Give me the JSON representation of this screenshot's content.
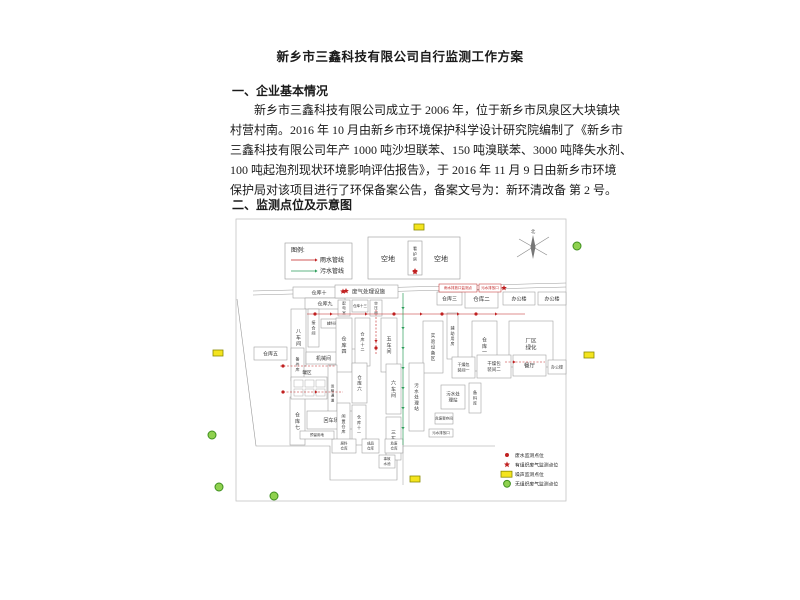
{
  "doc": {
    "title": "新乡市三鑫科技有限公司自行监测工作方案",
    "section1": "一、企业基本情况",
    "para_lines": [
      "新乡市三鑫科技有限公司成立于 2006 年，位于新乡市凤泉区大块镇块",
      "村营村南。2016 年 10 月由新乡市环境保护科学设计研究院编制了《新乡市",
      "三鑫科技有限公司年产 1000 吨沙坦联苯、150 吨溴联苯、3000 吨降失水剂、",
      "100 吨起泡剂现状环境影响评估报告》，于 2016 年 11 月 9 日由新乡市环境",
      "保护局对该项目进行了环保备案公告，备案文号为：新环清改备 第 2 号。"
    ],
    "section2": "二、监测点位及示意图"
  },
  "colors": {
    "red": "#c02020",
    "green": "#2e9e5b",
    "line": "#9a9a9a",
    "frame": "#c4c4c4",
    "text": "#444444",
    "yellow_fill": "#f4e41e",
    "yellow_stroke": "#8a8a00",
    "green_fill": "#8fd14f",
    "green_stroke": "#3f8f1f"
  },
  "diagram": {
    "frame": {
      "x": 41,
      "y": 4,
      "w": 330,
      "h": 282
    },
    "legend_top": {
      "x": 90,
      "y": 28,
      "w": 67,
      "h": 36,
      "title": "图例:",
      "items": [
        {
          "label": "雨水管线",
          "color": "#c02020"
        },
        {
          "label": "污水管线",
          "color": "#2e9e5b"
        }
      ]
    },
    "open_area": {
      "x": 173,
      "y": 22,
      "w": 92,
      "h": 42,
      "left_label": "空地",
      "right_label": "空地",
      "guard": {
        "x": 213,
        "y": 26,
        "w": 14,
        "h": 34,
        "label": "看护房"
      }
    },
    "compass": {
      "cx": 338,
      "cy": 32,
      "label": "北"
    },
    "roads": [
      {
        "x1": 58,
        "y1": 76,
        "x2": 371,
        "y2": 68
      },
      {
        "x1": 58,
        "y1": 80,
        "x2": 371,
        "y2": 72
      }
    ],
    "outline": "M42,84 L61,231 L135,231 L135,265 L202,265 L202,231 L300,231",
    "buildings": [
      {
        "l": "仓库十",
        "x": 98,
        "y": 72,
        "w": 52,
        "h": 11,
        "o": "h",
        "fs": 5
      },
      {
        "l": "仓库九",
        "x": 110,
        "y": 83,
        "w": 40,
        "h": 11,
        "o": "h",
        "fs": 5
      },
      {
        "l": "八车间",
        "x": 96,
        "y": 94,
        "w": 15,
        "h": 57,
        "o": "v",
        "fs": 5
      },
      {
        "l": "接合间",
        "x": 113,
        "y": 94,
        "w": 11,
        "h": 38,
        "o": "v",
        "fs": 4
      },
      {
        "l": "辅料间(二)",
        "x": 126,
        "y": 104,
        "w": 28,
        "h": 9,
        "o": "h",
        "fs": 3.5
      },
      {
        "l": "仓库五",
        "x": 59,
        "y": 132,
        "w": 33,
        "h": 13,
        "o": "h",
        "fs": 5
      },
      {
        "l": "备件库",
        "x": 96,
        "y": 133,
        "w": 13,
        "h": 33,
        "o": "v",
        "fs": 4
      },
      {
        "l": "机械间",
        "x": 111,
        "y": 137,
        "w": 35,
        "h": 12,
        "o": "h",
        "fs": 5
      },
      {
        "l": "机修间",
        "x": 148,
        "y": 134,
        "w": 13,
        "h": 17,
        "o": "v",
        "fs": 3.5
      },
      {
        "l": "废气处理设施",
        "x": 140,
        "y": 70,
        "w": 63,
        "h": 13,
        "o": "h",
        "fs": 5.5,
        "star": 1
      },
      {
        "l": "配电室",
        "x": 143,
        "y": 85,
        "w": 12,
        "h": 16,
        "o": "v",
        "fs": 3.5
      },
      {
        "l": "仓库十三",
        "x": 157,
        "y": 85,
        "w": 16,
        "h": 12,
        "o": "h",
        "fs": 3.5
      },
      {
        "l": "空压间",
        "x": 175,
        "y": 85,
        "w": 12,
        "h": 16,
        "o": "v",
        "fs": 3.5
      },
      {
        "l": "仓库四",
        "x": 141,
        "y": 103,
        "w": 16,
        "h": 54,
        "o": "v",
        "fs": 5
      },
      {
        "l": "仓库十二",
        "x": 160,
        "y": 103,
        "w": 15,
        "h": 48,
        "o": "v",
        "fs": 4
      },
      {
        "l": "五车间",
        "x": 186,
        "y": 103,
        "w": 16,
        "h": 54,
        "o": "v",
        "fs": 5
      },
      {
        "l": "实验设备区",
        "x": 228,
        "y": 106,
        "w": 20,
        "h": 52,
        "o": "v",
        "fs": 4.5
      },
      {
        "l": "辅助用房",
        "x": 252,
        "y": 98,
        "w": 11,
        "h": 46,
        "o": "v",
        "fs": 4
      },
      {
        "l": "仓库一",
        "x": 277,
        "y": 106,
        "w": 25,
        "h": 50,
        "o": "v",
        "fs": 5
      },
      {
        "l": "厂区绿化",
        "x": 314,
        "y": 106,
        "w": 44,
        "h": 46,
        "o": "h2",
        "fs": 5.5,
        "lines": [
          "厂区",
          "绿化"
        ]
      },
      {
        "l": "仓库三",
        "x": 242,
        "y": 77,
        "w": 25,
        "h": 13,
        "o": "h",
        "fs": 5
      },
      {
        "l": "仓库二",
        "x": 270,
        "y": 75,
        "w": 33,
        "h": 18,
        "o": "h",
        "fs": 5.5
      },
      {
        "l": "办公楼",
        "x": 308,
        "y": 77,
        "w": 32,
        "h": 13,
        "o": "h",
        "fs": 5
      },
      {
        "l": "办公楼",
        "x": 343,
        "y": 77,
        "w": 28,
        "h": 13,
        "o": "h",
        "fs": 5
      },
      {
        "l": "仓库六",
        "x": 157,
        "y": 148,
        "w": 15,
        "h": 40,
        "o": "v",
        "fs": 4.5
      },
      {
        "l": "六车间",
        "x": 191,
        "y": 149,
        "w": 15,
        "h": 50,
        "o": "v",
        "fs": 5
      },
      {
        "l": "三车间",
        "x": 191,
        "y": 202,
        "w": 15,
        "h": 43,
        "o": "v",
        "fs": 5
      },
      {
        "l": "污水处理站",
        "x": 214,
        "y": 148,
        "w": 15,
        "h": 68,
        "o": "v",
        "fs": 4.5
      },
      {
        "l": "运输通道",
        "x": 133,
        "y": 150,
        "w": 9,
        "h": 56,
        "o": "v",
        "fs": 3.5
      },
      {
        "l": "仓库七",
        "x": 95,
        "y": 182,
        "w": 15,
        "h": 48,
        "o": "v",
        "fs": 5
      },
      {
        "l": "回车场",
        "x": 112,
        "y": 196,
        "w": 48,
        "h": 18,
        "o": "h",
        "fs": 5
      },
      {
        "l": "闲置仓库",
        "x": 142,
        "y": 188,
        "w": 13,
        "h": 42,
        "o": "v",
        "fs": 4
      },
      {
        "l": "仓库十一",
        "x": 157,
        "y": 190,
        "w": 14,
        "h": 40,
        "o": "v",
        "fs": 4
      },
      {
        "l": "干燥包装间一",
        "x": 257,
        "y": 142,
        "w": 23,
        "h": 21,
        "o": "h2",
        "fs": 4,
        "lines": [
          "干燥包",
          "装间一"
        ]
      },
      {
        "l": "干燥包装间二",
        "x": 282,
        "y": 140,
        "w": 34,
        "h": 23,
        "o": "h2",
        "fs": 4.5,
        "lines": [
          "干燥包",
          "装间二"
        ]
      },
      {
        "l": "餐厅",
        "x": 318,
        "y": 140,
        "w": 33,
        "h": 21,
        "o": "h",
        "fs": 5.5
      },
      {
        "l": "办公楼",
        "x": 353,
        "y": 145,
        "w": 18,
        "h": 14,
        "o": "h",
        "fs": 4
      },
      {
        "l": "污水处理站",
        "x": 246,
        "y": 170,
        "w": 24,
        "h": 24,
        "o": "h2",
        "fs": 4.5,
        "lines": [
          "污水处",
          "理站"
        ]
      },
      {
        "l": "备料库",
        "x": 274,
        "y": 168,
        "w": 12,
        "h": 30,
        "o": "v",
        "fs": 4
      },
      {
        "l": "危废暂存间",
        "x": 240,
        "y": 198,
        "w": 18,
        "h": 11,
        "o": "h",
        "fs": 3.5
      },
      {
        "l": "污水排放口",
        "x": 234,
        "y": 214,
        "w": 24,
        "h": 8,
        "o": "h",
        "fs": 3.5
      },
      {
        "l": "原料仓库",
        "x": 137,
        "y": 224,
        "w": 24,
        "h": 14,
        "o": "h2",
        "fs": 3.5,
        "lines": [
          "原料",
          "仓库"
        ]
      },
      {
        "l": "成品仓库",
        "x": 167,
        "y": 224,
        "w": 17,
        "h": 14,
        "o": "h2",
        "fs": 3.5,
        "lines": [
          "成品",
          "仓库"
        ]
      },
      {
        "l": "危废仓库",
        "x": 190,
        "y": 224,
        "w": 18,
        "h": 14,
        "o": "h2",
        "fs": 3.5,
        "lines": [
          "危废",
          "仓库"
        ]
      },
      {
        "l": "事故水池",
        "x": 184,
        "y": 240,
        "w": 16,
        "h": 13,
        "o": "h2",
        "fs": 3.5,
        "lines": [
          "事故",
          "水池"
        ]
      },
      {
        "l": "预留用地",
        "x": 105,
        "y": 216,
        "w": 34,
        "h": 8,
        "o": "h",
        "fs": 3.5
      }
    ],
    "tank_area": {
      "label": "罐区",
      "lx": 112,
      "ly": 159,
      "x": 96,
      "y": 162,
      "w": 36,
      "h": 22,
      "cells": [
        [
          99,
          165
        ],
        [
          110,
          165
        ],
        [
          121,
          165
        ],
        [
          99,
          174
        ],
        [
          110,
          174
        ],
        [
          121,
          174
        ]
      ],
      "cw": 9,
      "ch": 7
    },
    "annotations": [
      {
        "l": "雨水排放口监测点",
        "x": 244,
        "y": 69,
        "w": 38,
        "h": 8,
        "fs": 3.5
      },
      {
        "l": "污水排放口",
        "x": 284,
        "y": 69,
        "w": 22,
        "h": 8,
        "fs": 3.5
      }
    ],
    "pipes": {
      "red_lines": [
        {
          "x1": 112,
          "y1": 99,
          "x2": 330,
          "y2": 99
        },
        {
          "x1": 85,
          "y1": 151,
          "x2": 140,
          "y2": 151,
          "dash": 1
        },
        {
          "x1": 181,
          "y1": 95,
          "x2": 181,
          "y2": 140,
          "dash": 1
        },
        {
          "x1": 88,
          "y1": 177,
          "x2": 148,
          "y2": 177,
          "dash": 1
        },
        {
          "x1": 310,
          "y1": 147,
          "x2": 350,
          "y2": 147,
          "dash": 1
        }
      ],
      "red_arrows": [
        {
          "x": 135,
          "y": 99,
          "d": "r"
        },
        {
          "x": 170,
          "y": 99,
          "d": "r"
        },
        {
          "x": 225,
          "y": 99,
          "d": "r"
        },
        {
          "x": 262,
          "y": 99,
          "d": "r"
        },
        {
          "x": 300,
          "y": 99,
          "d": "r"
        },
        {
          "x": 181,
          "y": 125,
          "d": "d"
        },
        {
          "x": 120,
          "y": 177,
          "d": "r"
        },
        {
          "x": 318,
          "y": 147,
          "d": "r"
        }
      ],
      "red_dots": [
        [
          120,
          99
        ],
        [
          199,
          99
        ],
        [
          281,
          99
        ],
        [
          88,
          151
        ],
        [
          181,
          133
        ],
        [
          88,
          177
        ],
        [
          247,
          99
        ]
      ],
      "red_stars": [
        [
          220,
          57
        ],
        [
          151,
          76
        ],
        [
          309,
          73
        ]
      ],
      "green_line": {
        "x": 208,
        "y1": 78,
        "y2": 230
      },
      "green_arrow_ys": [
        92,
        112,
        132,
        152,
        172,
        192,
        212
      ],
      "gray_tail": {
        "x": 208,
        "y1": 230,
        "y2": 270
      }
    },
    "markers": {
      "yellow": [
        [
          219,
          9
        ],
        [
          18,
          135
        ],
        [
          389,
          137
        ],
        [
          215,
          261
        ]
      ],
      "green": [
        [
          382,
          31
        ],
        [
          17,
          220
        ],
        [
          24,
          272
        ],
        [
          79,
          281
        ]
      ]
    },
    "legend_bottom": {
      "x": 306,
      "y": 234,
      "items": [
        {
          "type": "dot",
          "label": "废水监测点位"
        },
        {
          "type": "star",
          "label": "有组织废气监测点位"
        },
        {
          "type": "rect",
          "label": "噪声监测点位"
        },
        {
          "type": "circle",
          "label": "无组织废气监测点位"
        }
      ]
    }
  }
}
